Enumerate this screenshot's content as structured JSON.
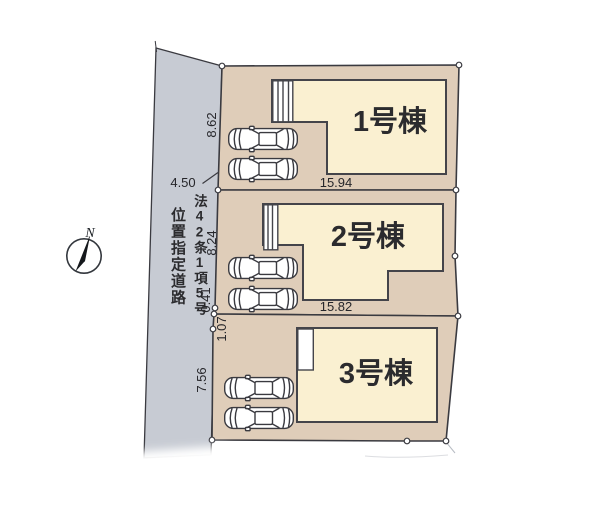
{
  "colors": {
    "road": "#c7cbd3",
    "lot": "#dfcdb9",
    "building": "#faf0d1",
    "white": "#ffffff"
  },
  "buildings": [
    {
      "label": "1号棟"
    },
    {
      "label": "2号棟"
    },
    {
      "label": "3号棟"
    }
  ],
  "dimensions": [
    {
      "value": "8.62"
    },
    {
      "value": "4.50"
    },
    {
      "value": "15.94"
    },
    {
      "value": "8.24"
    },
    {
      "value": "0.41"
    },
    {
      "value": "1.07"
    },
    {
      "value": "7.56"
    },
    {
      "value": "15.82"
    }
  ],
  "road_designation": {
    "column1": "法42条1項5号",
    "column2": "位置指定道路"
  },
  "compass": {
    "north_label": "N"
  }
}
